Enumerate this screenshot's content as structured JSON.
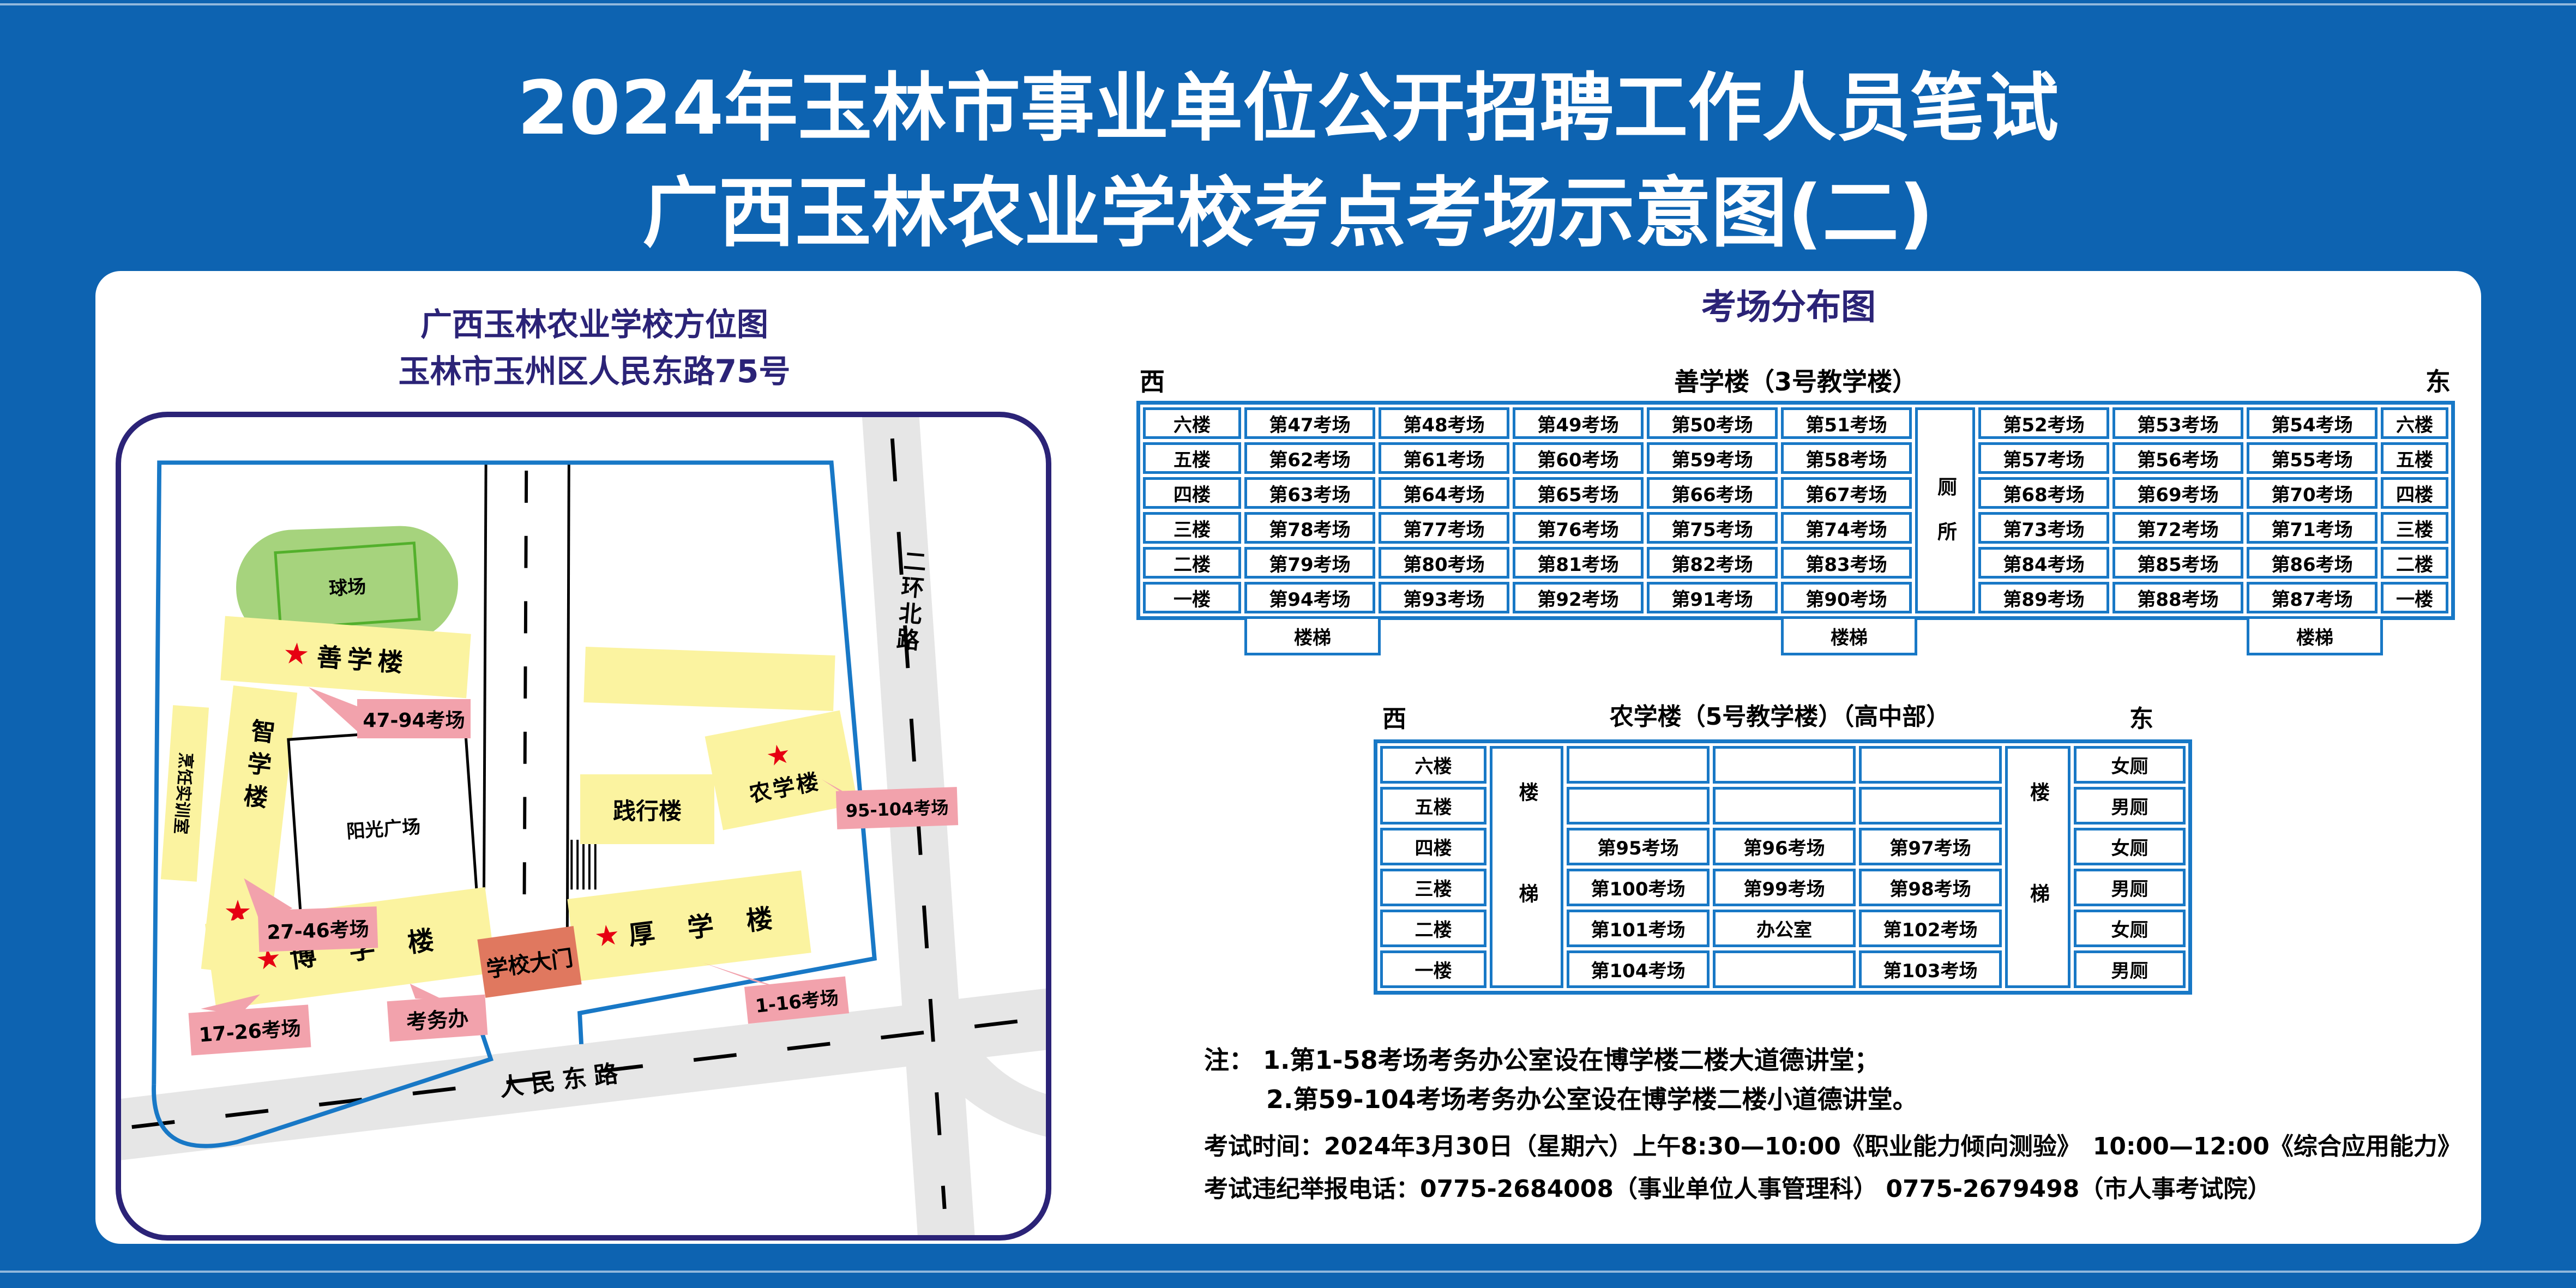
{
  "poster": {
    "title_line1": "2024年玉林市事业单位公开招聘工作人员笔试",
    "title_line2": "广西玉林农业学校考点考场示意图(二)"
  },
  "icons": {
    "star": "★"
  },
  "colors": {
    "background_blue": "#0d63b1",
    "frame_navy": "#2b2377",
    "table_blue": "#1878c6",
    "building_yellow": "#fbf3a0",
    "callout_pink": "#f2a2ac",
    "gate_salmon": "#e0785f",
    "field_green": "#a6d37d",
    "star_red": "#e60012",
    "road_gray": "#e6e6e6"
  },
  "map": {
    "title_line1": "广西玉林农业学校方位图",
    "title_line2": "玉林市玉州区人民东路75号",
    "labels": {
      "qiuchang": "球场",
      "shanxue": "善学楼",
      "zhixue": "智学楼",
      "pengren": "烹饪实训室",
      "yangguang": "阳光广场",
      "jianxing": "践行楼",
      "nongxue": "农学楼",
      "houxue": "厚 学 楼",
      "boxue": "博 学 楼",
      "gate": "学校大门",
      "kaowuban": "考务办",
      "renmin_road": "人民东路",
      "erhuan_road": "二环北路"
    },
    "ranges": {
      "shanxue": "47-94考场",
      "zhixue": "27-46考场",
      "nongxue": "95-104考场",
      "houxue": "1-16考场",
      "boxue": "17-26考场"
    }
  },
  "distribution": {
    "title": "考场分布图",
    "t1": {
      "west": "西",
      "east": "东",
      "building": "善学楼（3号教学楼）",
      "toilet": "厕所",
      "stairs": "楼梯",
      "floors": [
        "六楼",
        "五楼",
        "四楼",
        "三楼",
        "二楼",
        "一楼"
      ],
      "rows_left": [
        [
          "第47考场",
          "第48考场",
          "第49考场",
          "第50考场",
          "第51考场"
        ],
        [
          "第62考场",
          "第61考场",
          "第60考场",
          "第59考场",
          "第58考场"
        ],
        [
          "第63考场",
          "第64考场",
          "第65考场",
          "第66考场",
          "第67考场"
        ],
        [
          "第78考场",
          "第77考场",
          "第76考场",
          "第75考场",
          "第74考场"
        ],
        [
          "第79考场",
          "第80考场",
          "第81考场",
          "第82考场",
          "第83考场"
        ],
        [
          "第94考场",
          "第93考场",
          "第92考场",
          "第91考场",
          "第90考场"
        ]
      ],
      "rows_right": [
        [
          "第52考场",
          "第53考场",
          "第54考场"
        ],
        [
          "第57考场",
          "第56考场",
          "第55考场"
        ],
        [
          "第68考场",
          "第69考场",
          "第70考场"
        ],
        [
          "第73考场",
          "第72考场",
          "第71考场"
        ],
        [
          "第84考场",
          "第85考场",
          "第86考场"
        ],
        [
          "第89考场",
          "第88考场",
          "第87考场"
        ]
      ]
    },
    "t2": {
      "west": "西",
      "east": "东",
      "building": "农学楼（5号教学楼）（高中部）",
      "stairs": "楼梯",
      "floors": [
        "六楼",
        "五楼",
        "四楼",
        "三楼",
        "二楼",
        "一楼"
      ],
      "rows": [
        [
          "",
          "",
          ""
        ],
        [
          "",
          "",
          ""
        ],
        [
          "第95考场",
          "第96考场",
          "第97考场"
        ],
        [
          "第100考场",
          "第99考场",
          "第98考场"
        ],
        [
          "第101考场",
          "办公室",
          "第102考场"
        ],
        [
          "第104考场",
          "",
          "第103考场"
        ]
      ],
      "toilets": [
        "女厕",
        "男厕",
        "女厕",
        "男厕",
        "女厕",
        "男厕"
      ]
    }
  },
  "notes": {
    "line1": "注： 1.第1-58考场考务办公室设在博学楼二楼大道德讲堂；",
    "line2": "2.第59-104考场考务办公室设在博学楼二楼小道德讲堂。"
  },
  "footer": {
    "time": "考试时间：2024年3月30日（星期六）上午8:30—10:00《职业能力倾向测验》　10:00—12:00《综合应用能力》",
    "hotline": "考试违纪举报电话：0775-2684008（事业单位人事管理科） 0775-2679498（市人事考试院）"
  }
}
